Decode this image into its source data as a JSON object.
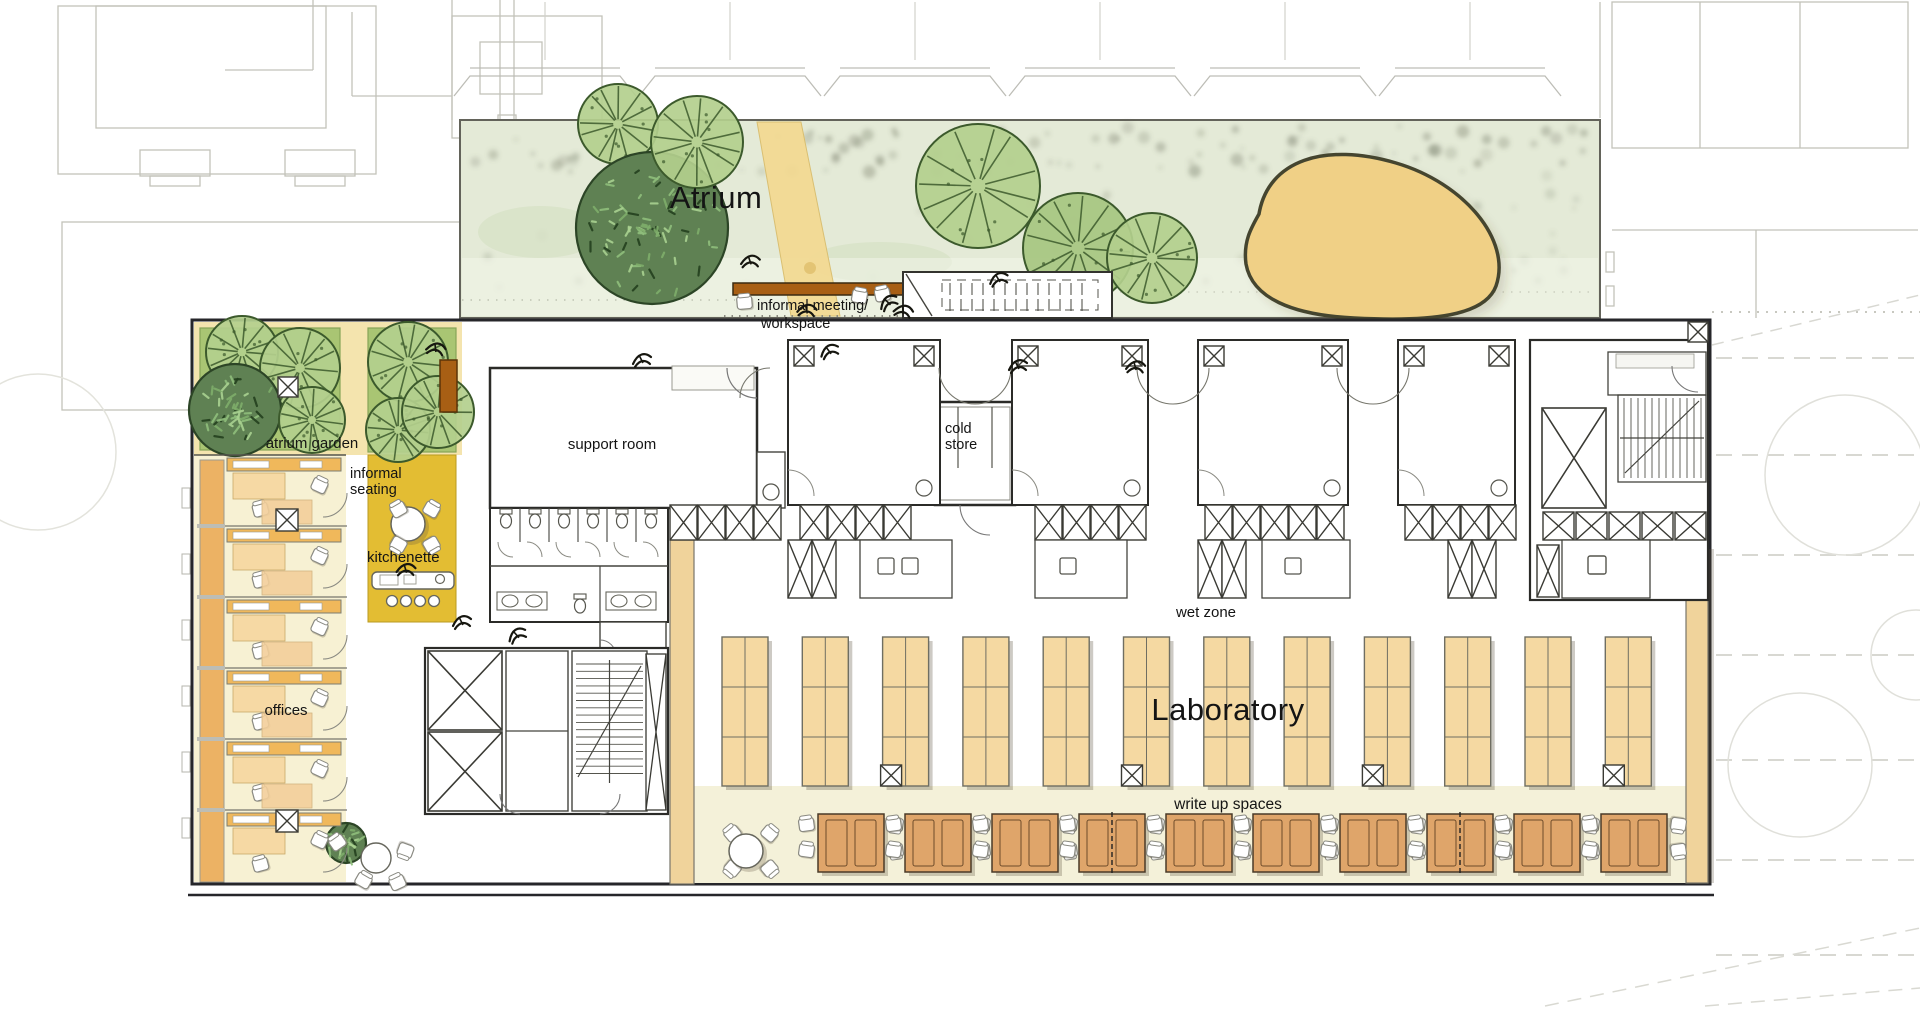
{
  "labels": {
    "atrium": "Atrium",
    "informal_meeting_line1": "informal meeting/",
    "informal_meeting_line2": "workspace",
    "atrium_garden": "atrium garden",
    "informal_seating_line1": "informal",
    "informal_seating_line2": "seating",
    "kitchenette": "kitchenette",
    "support_room": "support room",
    "cold_store_line1": "cold",
    "cold_store_line2": "store",
    "offices": "offices",
    "wet_zone": "wet zone",
    "laboratory": "Laboratory",
    "write_up_spaces": "write up spaces"
  },
  "colors": {
    "wall": "#2b2b28",
    "context_gray": "#c2c2ba",
    "atrium_bg": "#e4ead7",
    "atrium_wash": "#f3f5ea",
    "tree_light": "#b3cf8d",
    "tree_line": "#3c5a2c",
    "tree_dark_fill": "#5f8153",
    "sand": "#f0d086",
    "path_sand": "#f3da93",
    "garden_tan": "#f4e4ae",
    "garden_green": "#a9c573",
    "gold": "#e3bd33",
    "office_cream": "#f7f1d3",
    "desk_orange": "#f0b85b",
    "desk_light": "#f6d9a4",
    "bench_tan": "#f5d9a2",
    "writeup_bg": "#f4f1d9",
    "write_desk_brown": "#dfa56a",
    "wood_brown": "#a85f14",
    "strip_tan": "#f0d39b"
  },
  "furniture": {
    "lab_benches": {
      "count": 12,
      "rows_per_bench": 3,
      "columns_per_bench": 2
    },
    "write_up_desks": {
      "count": 10,
      "chairs_per_desk": 4
    },
    "offices": {
      "count": 6
    },
    "kitchenette_stools": 4,
    "informal_seating_chairs": 4,
    "toilet_stalls": 6
  }
}
